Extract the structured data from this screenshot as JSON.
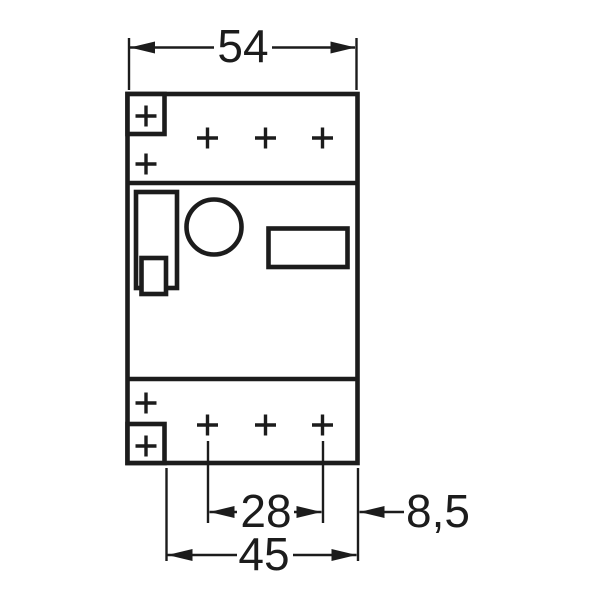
{
  "drawing": {
    "background_color": "#ffffff",
    "line_color": "#1c1c1c",
    "dimensions": {
      "top_width": "54",
      "terminal_span": "28",
      "bottom_width": "45",
      "right_offset": "8,5"
    }
  }
}
